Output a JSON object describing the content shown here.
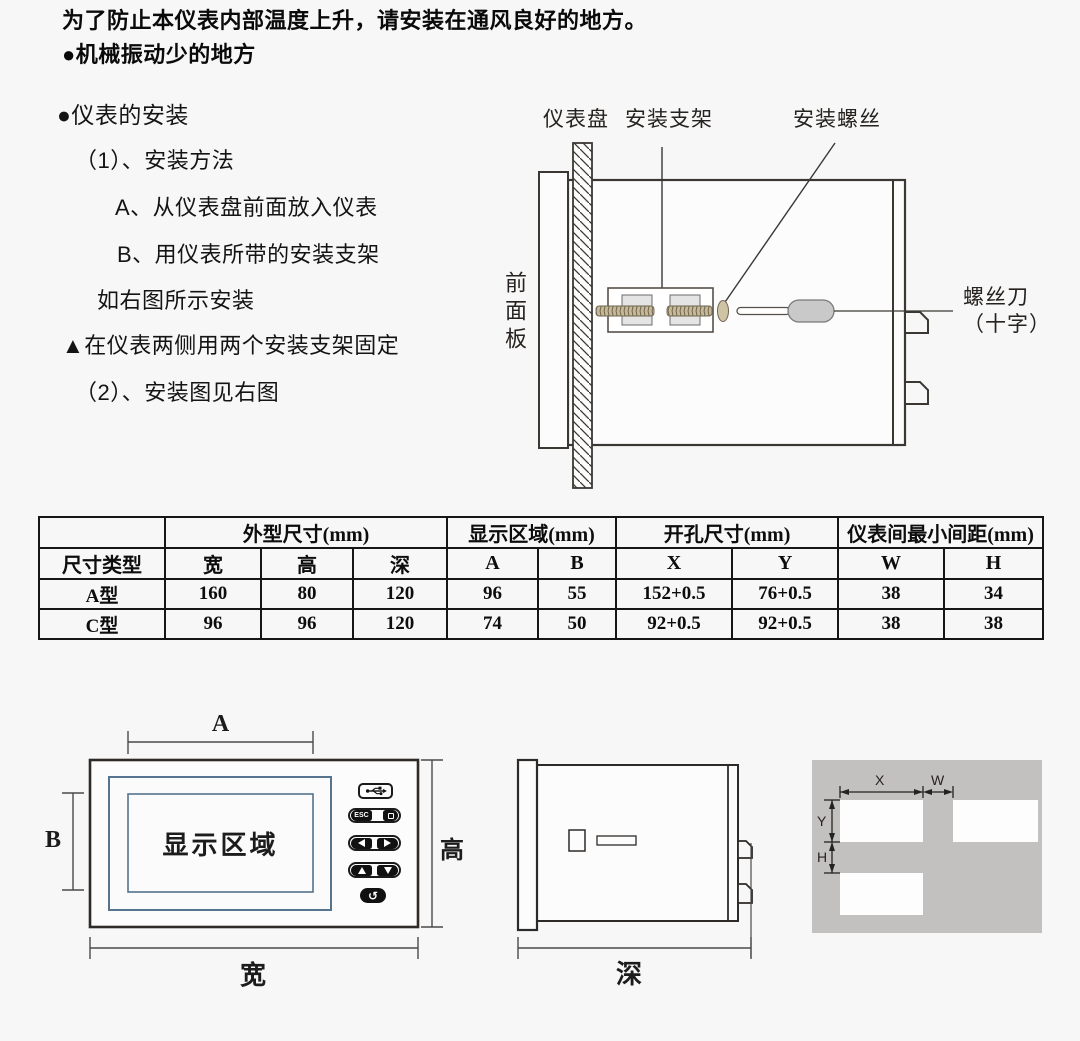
{
  "intro": {
    "line1": "为了防止本仪表内部温度上升，请安装在通风良好的地方。",
    "line2": "●机械振动少的地方"
  },
  "install": {
    "title": "●仪表的安装",
    "steps": [
      "（1）、安装方法",
      "A、从仪表盘前面放入仪表",
      "B、用仪表所带的安装支架",
      "如右图所示安装",
      "▲在仪表两侧用两个安装支架固定",
      "（2）、安装图见右图"
    ]
  },
  "install_diagram": {
    "panel_label": "仪表盘",
    "bracket_label": "安装支架",
    "screw_label": "安装螺丝",
    "front_panel_label": "前面板",
    "screwdriver_label_line1": "螺丝刀",
    "screwdriver_label_line2": "（十字）"
  },
  "dimensions_table": {
    "corner_header": "",
    "row_header_label": "尺寸类型",
    "group_headers": [
      "外型尺寸(mm)",
      "显示区域(mm)",
      "开孔尺寸(mm)",
      "仪表间最小间距(mm)"
    ],
    "sub_headers": [
      "宽",
      "高",
      "深",
      "A",
      "B",
      "X",
      "Y",
      "W",
      "H"
    ],
    "rows": [
      {
        "type": "A型",
        "values": [
          "160",
          "80",
          "120",
          "96",
          "55",
          "152+0.5",
          "76+0.5",
          "38",
          "34"
        ]
      },
      {
        "type": "C型",
        "values": [
          "96",
          "96",
          "120",
          "74",
          "50",
          "92+0.5",
          "92+0.5",
          "38",
          "38"
        ]
      }
    ]
  },
  "front_view": {
    "display_area_label": "显示区域",
    "dim_a": "A",
    "dim_b": "B",
    "dim_height": "高",
    "dim_width": "宽",
    "esc_button_label": "ESC",
    "enter_glyph": "↺"
  },
  "side_view": {
    "dim_depth": "深"
  },
  "cutout_view": {
    "dim_x": "X",
    "dim_w": "W",
    "dim_y": "Y",
    "dim_h": "H"
  },
  "colors": {
    "display_border": "#56748e",
    "panel_gray": "#c3c1bf",
    "diagram_line": "#3b3834",
    "screw_tan": "#c6b996"
  }
}
